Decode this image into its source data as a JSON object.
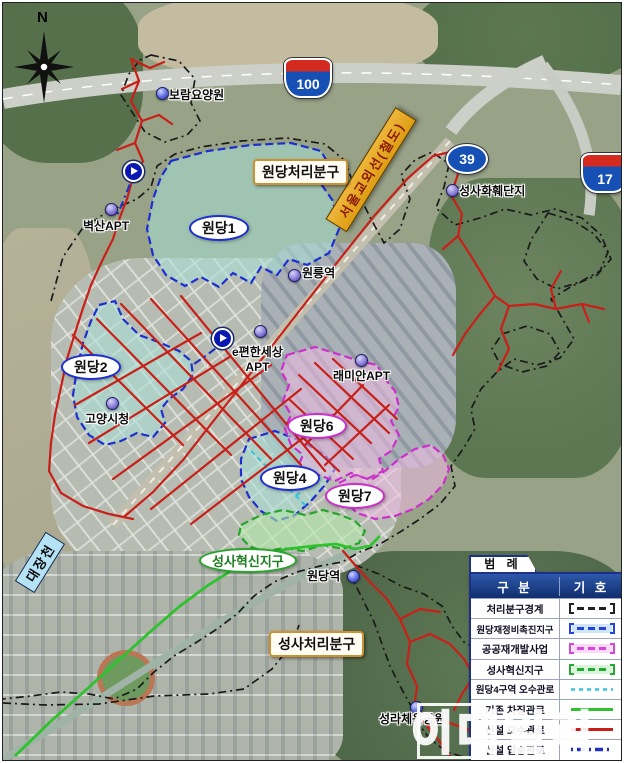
{
  "map": {
    "compass_label": "N",
    "route_shields": [
      {
        "name": "expressway-100",
        "number": "100"
      },
      {
        "name": "national-route-39",
        "number": "39"
      },
      {
        "name": "expressway-17",
        "number": "17"
      }
    ],
    "railway_label": "서울교외선(철도)",
    "stream_label": "대장천",
    "district_boxes": [
      {
        "label": "원당처리분구"
      },
      {
        "label": "성사처리분구"
      }
    ],
    "zones": [
      {
        "label": "원당1",
        "category": "원당재정비촉진지구",
        "color": "#1d2fd0"
      },
      {
        "label": "원당2",
        "category": "원당재정비촉진지구",
        "color": "#1d2fd0"
      },
      {
        "label": "원당4",
        "category": "원당재정비촉진지구",
        "color": "#1d2fd0"
      },
      {
        "label": "원당6",
        "category": "공공재개발사업",
        "color": "#cc2fcc"
      },
      {
        "label": "원당7",
        "category": "공공재개발사업",
        "color": "#cc2fcc"
      },
      {
        "label": "성사혁신지구",
        "category": "성사혁신지구",
        "color": "#27a52b"
      }
    ],
    "pois": [
      {
        "label": "보람요양원"
      },
      {
        "label": "벽산APT"
      },
      {
        "label": "원릉역"
      },
      {
        "label": "e편한세상",
        "sublabel": "APT"
      },
      {
        "label": "래미안APT"
      },
      {
        "label": "고양시청"
      },
      {
        "label": "성사화훼단지"
      },
      {
        "label": "원당역"
      },
      {
        "label": "성라체육공원"
      }
    ]
  },
  "legend": {
    "title": "범 례",
    "columns": [
      "구 분",
      "기 호"
    ],
    "rows": [
      {
        "label": "처리분구경계",
        "symbol": "dashed-bracket",
        "color": "#222222"
      },
      {
        "label": "원당재정비촉진지구",
        "symbol": "dashed-bracket",
        "color": "#2244dd"
      },
      {
        "label": "공공재개발사업",
        "symbol": "dashed-bracket",
        "color": "#dd44dd"
      },
      {
        "label": "성사혁신지구",
        "symbol": "dashed-bracket",
        "color": "#22aa33"
      },
      {
        "label": "원당4구역 오수관로",
        "symbol": "dashed-line",
        "color": "#35c2e0"
      },
      {
        "label": "기존 차집관로",
        "symbol": "solid-line",
        "color": "#2ec22e"
      },
      {
        "label": "신설 오수관로",
        "symbol": "solid-line",
        "color": "#c82018"
      },
      {
        "label": "신설 압송관로",
        "symbol": "dash-dot-line",
        "color": "#2030c0"
      },
      {
        "label": "신설 맨홀펌프장",
        "symbol": "pump-icon",
        "color": "#0a18b2"
      }
    ]
  },
  "watermark": "이데일리"
}
